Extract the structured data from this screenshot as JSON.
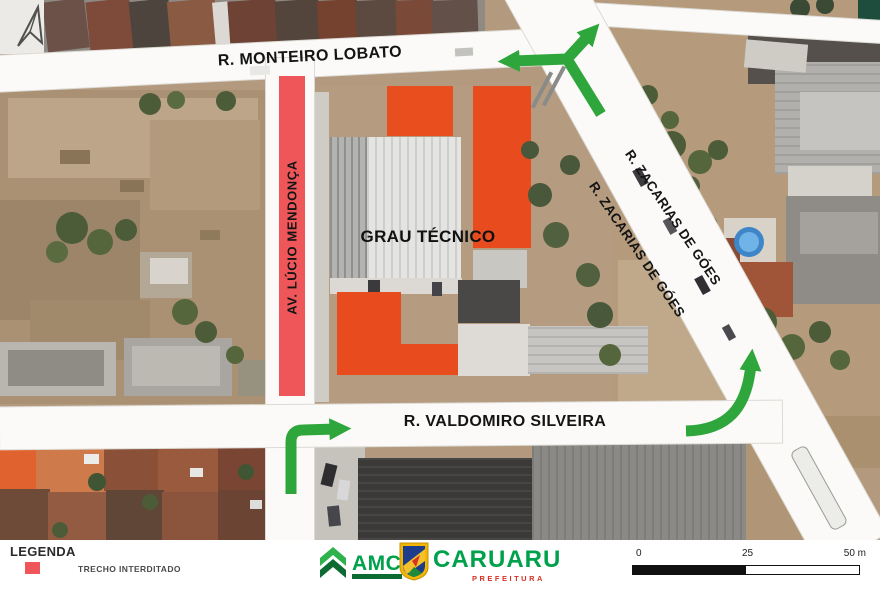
{
  "streets": {
    "monteiro": "R. MONTEIRO LOBATO",
    "zacarias": "R. ZACARIAS DE GÓES",
    "lucio": "AV. LÚCIO MENDONÇA",
    "valdomiro": "R. VALDOMIRO SILVEIRA"
  },
  "building": {
    "label": "GRAU TÉCNICO"
  },
  "legend": {
    "title": "LEGENDA",
    "item": "TRECHO INTERDITADO"
  },
  "logos": {
    "amc": "AMC",
    "caruaru": "CARUARU",
    "caruaru_subtitle": "PREFEITURA"
  },
  "scale": {
    "t0": "0",
    "t1": "25",
    "t2": "50 m"
  },
  "colors": {
    "arrow_green": "#2fa63c",
    "closed_red": "#ef5659",
    "amc_green": "#00a14b",
    "caruaru_green": "#00a14b",
    "prefeitura_red": "#d93025",
    "road_white": "#fbfaf8"
  }
}
